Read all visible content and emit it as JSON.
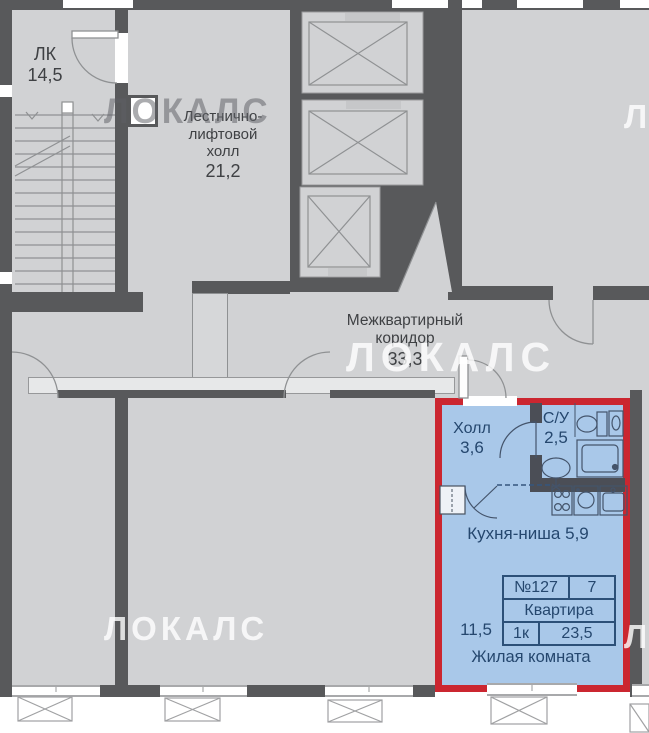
{
  "watermark": {
    "text": "ЛОКАЛС"
  },
  "plan": {
    "stairwell": {
      "name": "ЛК",
      "area": "14,5"
    },
    "lift_hall": {
      "name_line1": "Лестнично-",
      "name_line2": "лифтовой",
      "name_line3": "холл",
      "area": "21,2"
    },
    "corridor": {
      "name_line1": "Межквартирный",
      "name_line2": "коридор",
      "area": "33,3"
    }
  },
  "apartment": {
    "hall": {
      "name": "Холл",
      "area": "3,6"
    },
    "bathroom": {
      "name": "С/У",
      "area": "2,5"
    },
    "kitchen_label": "Кухня-ниша 5,9",
    "living_room_label": "Жилая комната",
    "living_room_area": "11,5",
    "info": {
      "number": "№127",
      "floor": "7",
      "type": "Квартира",
      "rooms": "1к",
      "total_area": "23,5"
    },
    "colors": {
      "highlight_border": "#cb2630",
      "fill": "#a9c8e9"
    }
  }
}
